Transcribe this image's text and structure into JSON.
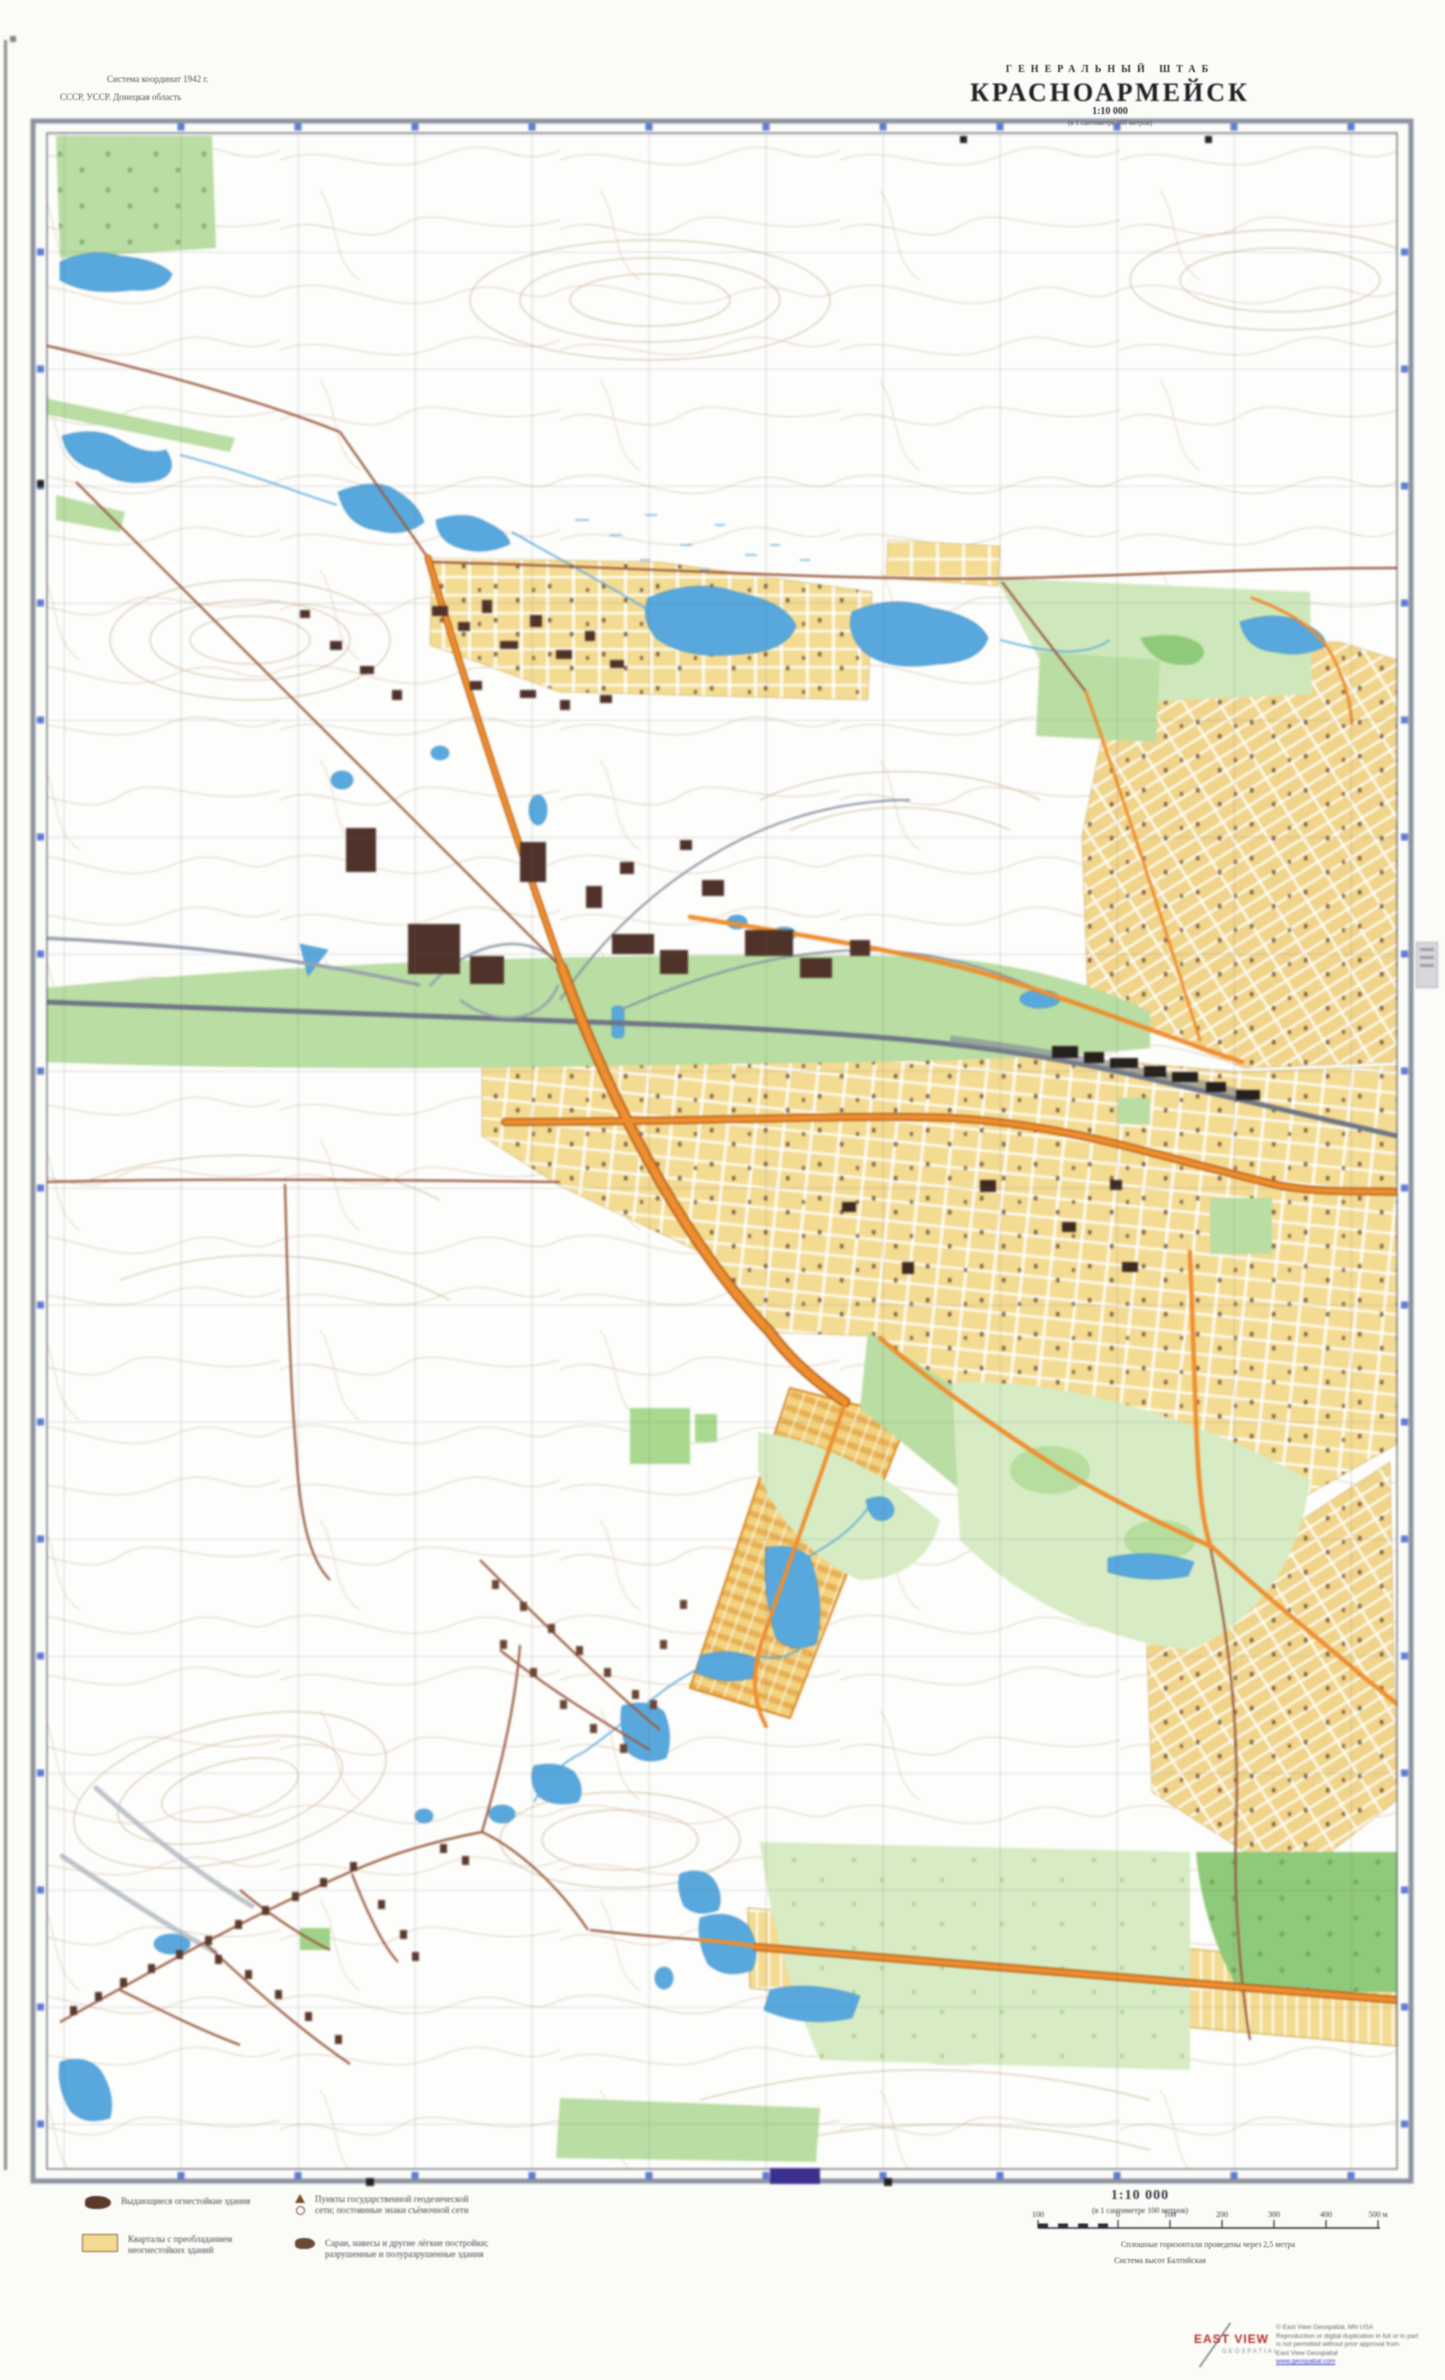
{
  "header": {
    "note_line1": "Система координат 1942 г.",
    "note_line2": "СССР, УССР. Донецкая область",
    "agency": "ГЕНЕРАЛЬНЫЙ ШТАБ",
    "title": "КРАСНОАРМЕЙСК",
    "sheet_line": "1:10 000",
    "sheet_line2": "(в 1 сантиметре 100 метров)"
  },
  "legend": {
    "items": [
      {
        "icon": "fireproof-building-blob",
        "lines": [
          "Выдающиеся огнестойкие здания"
        ]
      },
      {
        "icon": "quarter-fill",
        "lines": [
          "Кварталы с преобладанием",
          "неогнестойких зданий"
        ]
      },
      {
        "icon": "geodetic-symbols",
        "lines": [
          "Пункты государственной геодезической",
          "сети; постоянные знаки съёмочной сети"
        ]
      },
      {
        "icon": "light-structures-blob",
        "lines": [
          "Сараи, навесы и другие лёгкие постройки;",
          "разрушенные и полуразрушенные здания"
        ]
      }
    ]
  },
  "scale": {
    "title": "1:10 000",
    "note": "(в 1 сантиметре 100 метров)",
    "bar_labels": [
      "100",
      "0",
      "100",
      "200",
      "300",
      "400",
      "500 м"
    ],
    "footnote1": "Сплошные горизонтали проведены через 2,5 метра",
    "footnote2": "Система высот Балтийская"
  },
  "publisher": {
    "name_top": "EAST VIEW",
    "name_bottom": "GEOSPATIAL",
    "lines": [
      "© East View Geospatial, MN USA",
      "Reproduction or digital duplication in full or in part",
      "is not permitted without prior approval from",
      "East View Geospatial"
    ],
    "link": "www.geospatial.com"
  },
  "colors": {
    "paper": "#fdfdfb",
    "contour": "#cdb697",
    "water": "#58a8dd",
    "green": "#b9dda2",
    "green_light": "#d7ecc4",
    "forest_dark": "#8fc97a",
    "blocks_yellow": "#f3db92",
    "road_orange": "#ef8e2e",
    "road_brown": "#9a5a3f",
    "railway_gray": "#7d8694",
    "frame_gray": "#8d93a0",
    "grid_blue_ticks": "#4466cc",
    "purple_stamp": "#3b2f8e",
    "logo_red": "#b8342c",
    "link_blue": "#3a3acc"
  }
}
